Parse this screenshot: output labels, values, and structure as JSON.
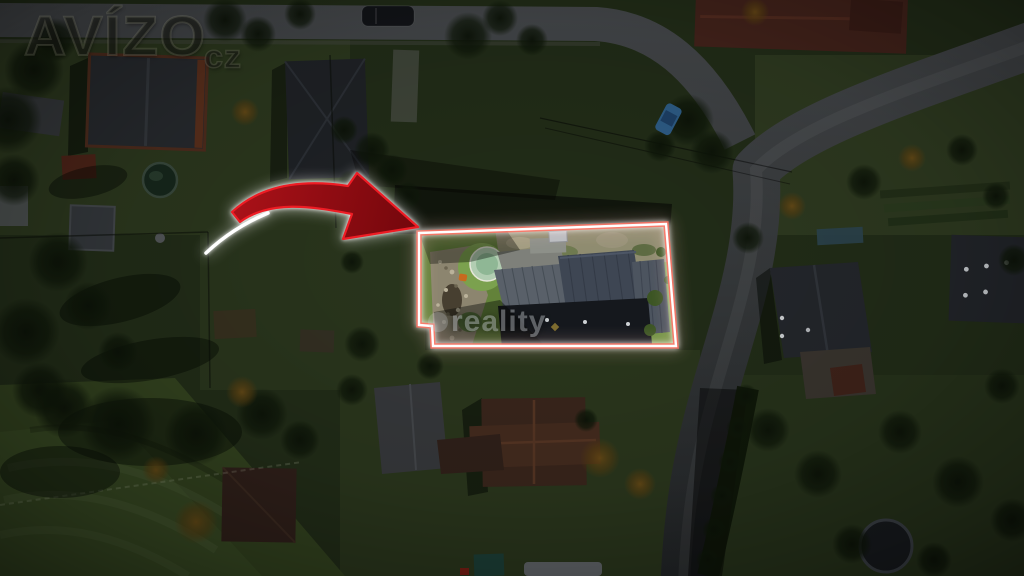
{
  "watermarks": {
    "brand_text": "AVÍZO",
    "brand_suffix": "cz",
    "agency_text": "reality"
  },
  "colors": {
    "arrow_fill": "#8f0d13",
    "arrow_stroke": "#ee1c24",
    "arrow_glow": "#ffffff",
    "plot_outline_inner": "#ffffff",
    "plot_outline_outer": "#ff6f5f"
  }
}
